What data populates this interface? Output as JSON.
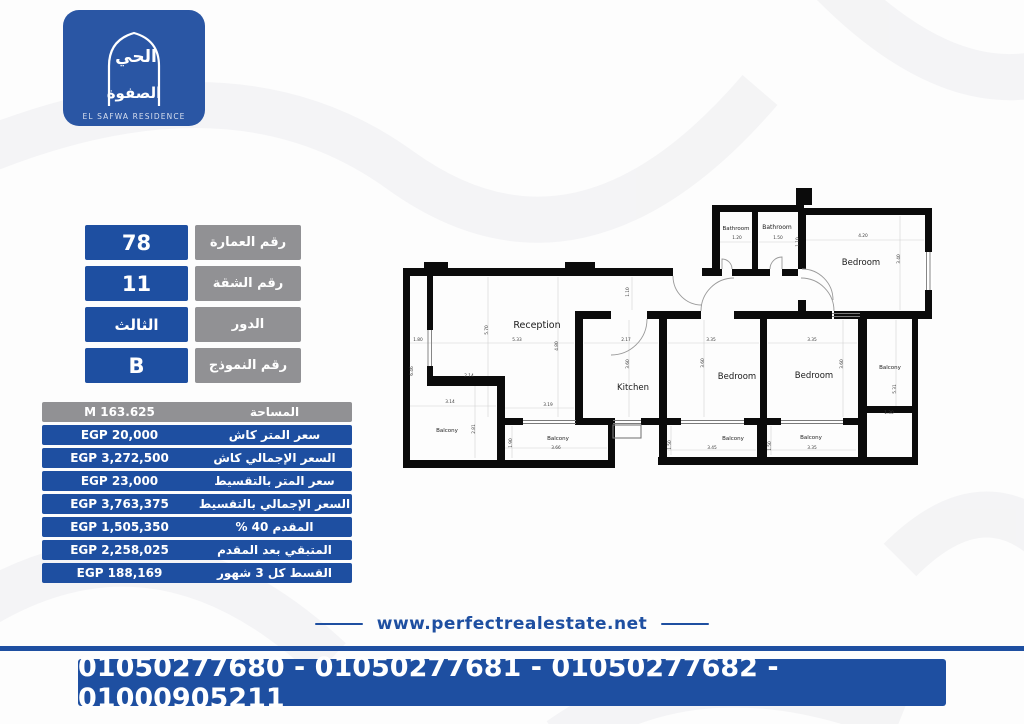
{
  "logo": {
    "arabic_line1": "الحي",
    "arabic_line2": "الصفوة",
    "name": "EL SAFWA RESIDENCE"
  },
  "info_rows": [
    {
      "label": "رقم العمارة",
      "value": "78"
    },
    {
      "label": "رقم الشقة",
      "value": "11"
    },
    {
      "label": "الدور",
      "value": "الثالث"
    },
    {
      "label": "رقم النموذج",
      "value": "B"
    }
  ],
  "price_rows": [
    {
      "label": "المساحة",
      "value": "M 163.625"
    },
    {
      "label": "سعر المتر كاش",
      "value": "EGP 20,000"
    },
    {
      "label": "السعر الإجمالي كاش",
      "value": "EGP 3,272,500"
    },
    {
      "label": "سعر المتر بالتقسيط",
      "value": "EGP 23,000"
    },
    {
      "label": "السعر الإجمالي بالتقسيط",
      "value": "EGP 3,763,375"
    },
    {
      "label": "المقدم 40 %",
      "value": "EGP 1,505,350"
    },
    {
      "label": "المتبقي بعد المقدم",
      "value": "EGP 2,258,025"
    },
    {
      "label": "القسط كل 3 شهور",
      "value": "EGP 188,169"
    }
  ],
  "floorplan": {
    "room_labels": [
      "Reception",
      "Kitchen",
      "Bedroom",
      "Bedroom",
      "Bedroom",
      "Bathroom",
      "Bathroom",
      "Balcony",
      "Balcony",
      "Balcony",
      "Balcony",
      "Balcony"
    ],
    "dimension_labels": [
      "5.70",
      "5.33",
      "4.80",
      "1.80",
      "6.46",
      "2.14",
      "3.14",
      "3.19",
      "2.81",
      "1.90",
      "3.66",
      "1.10",
      "2.17",
      "3.60",
      "3.35",
      "3.60",
      "1.50",
      "3.45",
      "3.35",
      "3.60",
      "1.50",
      "3.35",
      "1.20",
      "1.50",
      "1.10",
      "4.20",
      "3.40",
      "5.31",
      "1.30"
    ]
  },
  "footer": {
    "website": "www.perfectrealestate.net",
    "phones": "01050277680 - 01050277681 - 01050277682 - 01000905211"
  },
  "colors": {
    "primary_blue": "#1e4fa1",
    "logo_blue": "#2a56a4",
    "gray": "#919194",
    "wall": "#0b0b0b"
  }
}
